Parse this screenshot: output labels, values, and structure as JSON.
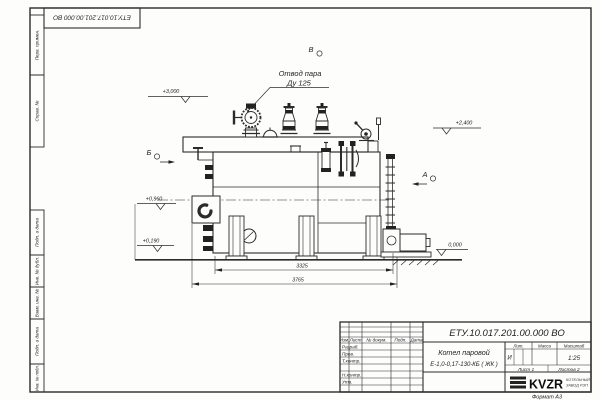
{
  "page": {
    "format_label": "Формат А3"
  },
  "corner_stamp": {
    "doc_number": "ЕТУ.10.017.201.00.000 ВО"
  },
  "margin": {
    "boxes": [
      {
        "label": "Перв. примен."
      },
      {
        "label": "Справ. №"
      },
      {
        "label": "Подп. и дата"
      },
      {
        "label": "Инв. № дубл."
      },
      {
        "label": "Взам. инв. №"
      },
      {
        "label": "Подп. и дата"
      },
      {
        "label": "Инв. № подл."
      }
    ]
  },
  "drawing": {
    "callout": {
      "line1": "Отвод пара",
      "line2": "Ду 125"
    },
    "view_markers": {
      "top": "В",
      "left": "Б",
      "right": "А"
    },
    "elevations": {
      "e3000": "+3,000",
      "e2400": "+2,400",
      "e0960": "+0,960",
      "e0190": "+0,190",
      "e0000": "0,000"
    },
    "dimensions": {
      "inner": "3325",
      "overall": "3765"
    }
  },
  "title_block": {
    "doc_number": "ЕТУ.10.017.201.00.000 ВО",
    "product": {
      "line1": "Котел паровой",
      "line2": "Е-1,0-0,17-130-КБ ( ЖК )"
    },
    "cols": {
      "lit": "Лит.",
      "mass": "Масса",
      "scale": "Масштаб"
    },
    "values": {
      "lit": "И",
      "scale": "1:25"
    },
    "sheet_row": {
      "sheet": "Лист 1",
      "sheets": "Листов 2"
    },
    "approval_rows": {
      "r1": "Разраб.",
      "r2": "Пров.",
      "r3": "Т.контр.",
      "r4": "Н.контр.",
      "r5": "Утв."
    },
    "header_row": {
      "c1": "Изм.",
      "c2": "Лист",
      "c3": "№ докум.",
      "c4": "Подп.",
      "c5": "Дата"
    },
    "logo": {
      "name": "KVZR",
      "sub1": "КОТЕЛЬНЫЙ",
      "sub2": "ЗАВОД РЭП"
    }
  }
}
